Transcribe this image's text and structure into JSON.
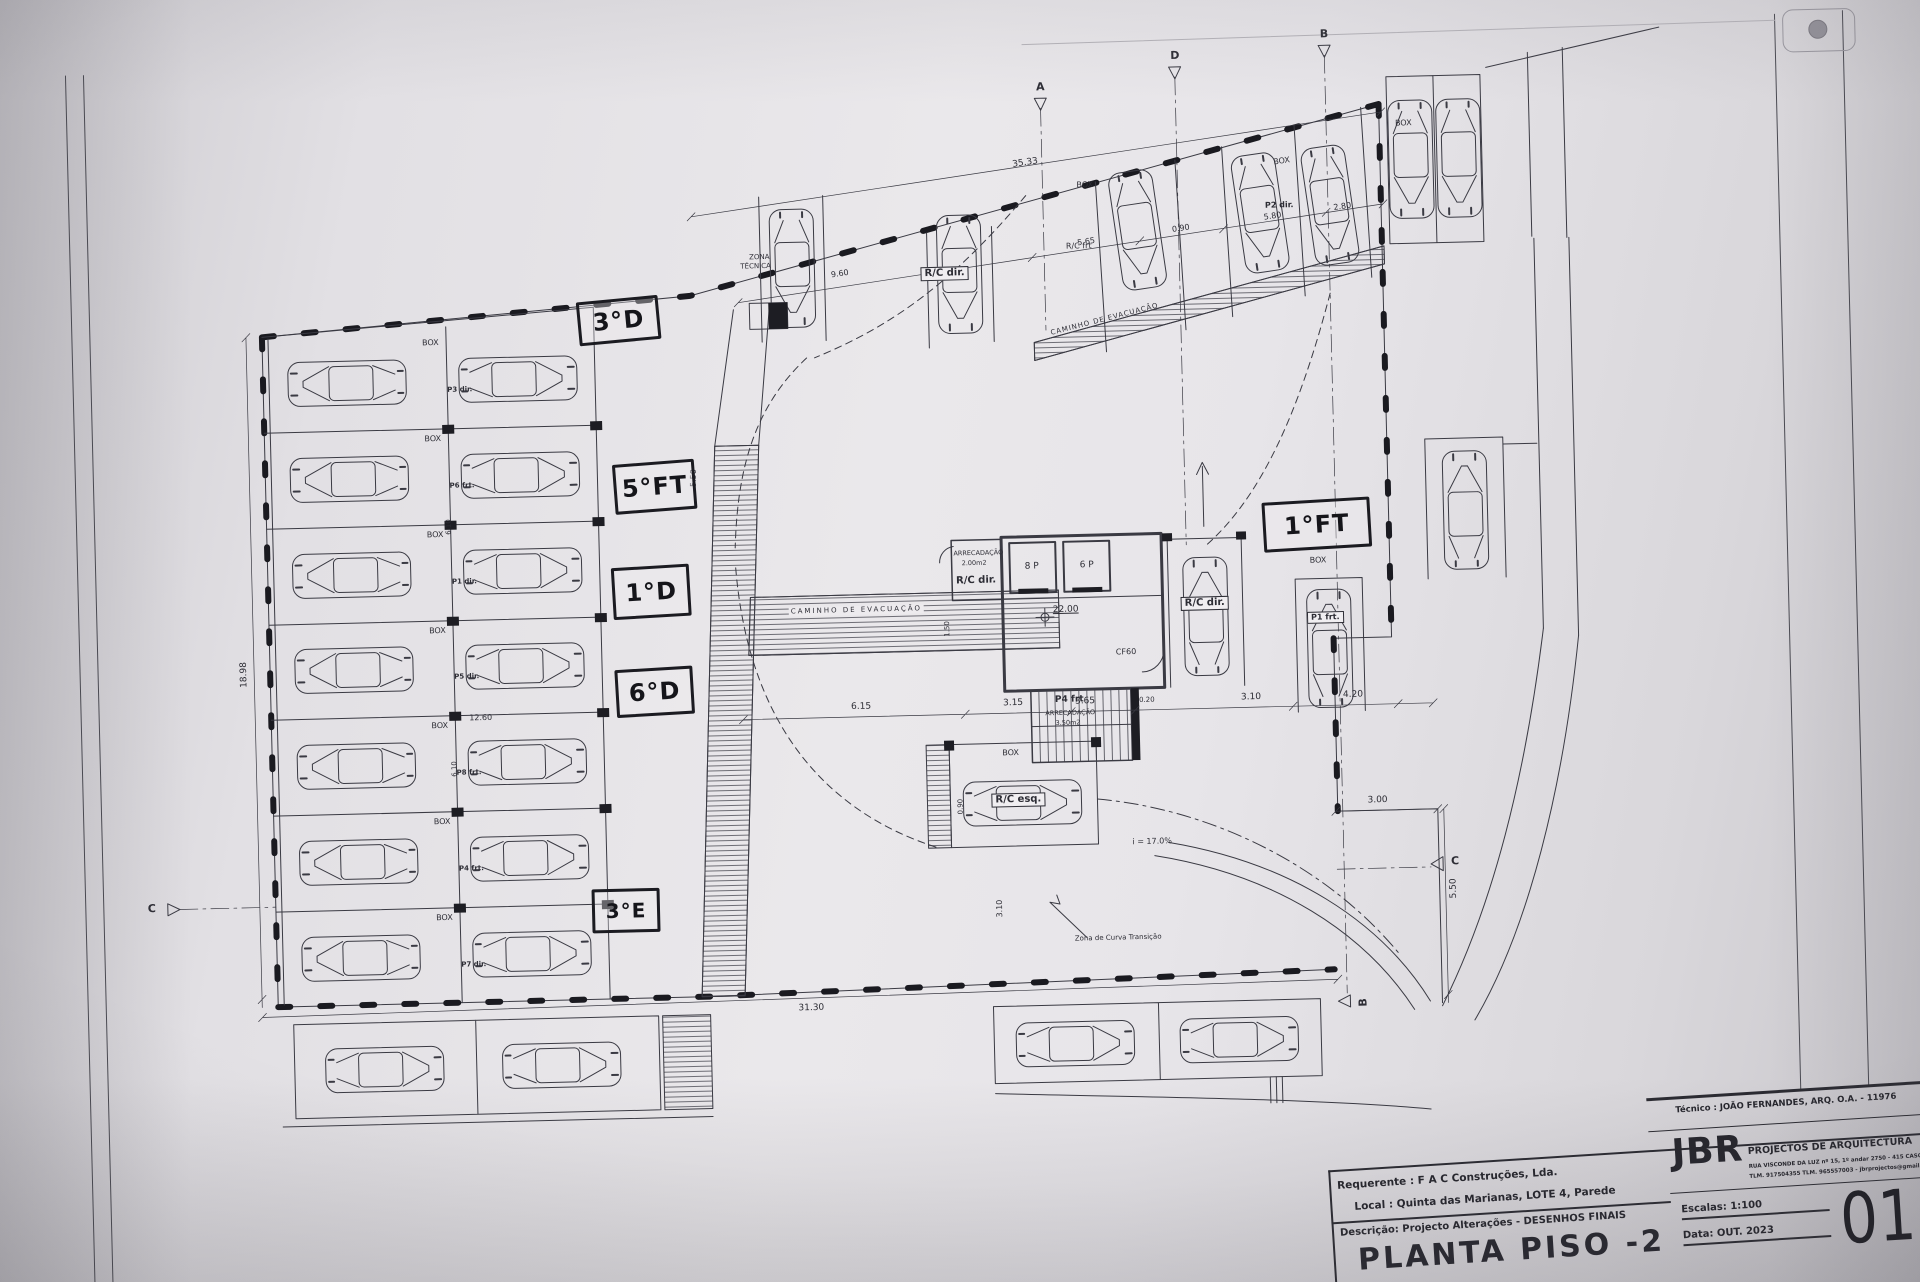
{
  "title_block": {
    "tecnico": "Técnico : JOÃO FERNANDES, ARQ.   O.A. - 11976",
    "firm_initials": "JBR",
    "firm_name": "PROJECTOS DE ARQUITECTURA",
    "firm_address": "RUA VISCONDE DA LUZ nº 15, 1º andar  2750 - 415  CASCAIS",
    "firm_contacts": "TLM. 917504355  TLM. 965557003 - jbrprojectos@gmail.com",
    "requerente_label": "Requerente :",
    "requerente_value": "F A C  Construções, Lda.",
    "local_label": "Local :",
    "local_value": "Quinta das Marianas, LOTE 4, Parede",
    "descricao_label": "Descrição:",
    "descricao_value": "Projecto Alterações - DESENHOS FINAIS",
    "escala": "Escalas:  1:100",
    "data": "Data: OUT.  2023",
    "sheet_number": "01",
    "drawing_title": "PLANTA PISO -2"
  },
  "handwritten": {
    "n3d": "3°D",
    "n5ft": "5°FT",
    "n1d": "1°D",
    "n6d": "6°D",
    "n3e": "3°E",
    "n1ft": "1°FT"
  },
  "labels": {
    "box": "BOX",
    "zona": "ZONA",
    "tecnica": "TÉCNICA",
    "caminho_evacuacao": "CAMINHO  DE  EVACUAÇÃO",
    "arrecadacao": "ARRECADAÇÃO",
    "arrecadacao_area_1": "2.00m2",
    "arrecadacao_area_2": "3.50m2",
    "rc_dir": "R/C dir.",
    "rc_frt": "R/C frt",
    "rc_esq": "R/C esq.",
    "p2_dir": "P2 dir.",
    "p1_frt": "P1 frt.",
    "p4_frt": "P4 frt",
    "lift_8p": "8 P",
    "lift_6p": "6 P",
    "cf60": "CF60",
    "level": "22.00",
    "slope": "i = 17.0%",
    "curva_transicao": "Zona de Curva Transição"
  },
  "left_rows": [
    {
      "box": "BOX",
      "p": "P3 dir."
    },
    {
      "box": "BOX",
      "p": "P6 frt."
    },
    {
      "box": "BOX",
      "p": "P1 dir."
    },
    {
      "box": "BOX",
      "p": "P5 dir."
    },
    {
      "box": "BOX",
      "p": "P8 frt."
    },
    {
      "box": "BOX",
      "p": "P4 frt."
    },
    {
      "box": "BOX",
      "p": "P7 dir."
    }
  ],
  "dims": {
    "d3533": "35.33",
    "d960": "9.60",
    "d565": "5.65",
    "d090": "0.90",
    "d580": "5.80",
    "d280": "2.80",
    "d3130": "31.30",
    "d1260": "12.60",
    "d610": "6.10",
    "d1898": "18.98",
    "d550": "5.50",
    "d150": "1.50",
    "d615": "6.15",
    "d315": "3.15",
    "d365": "3.65",
    "d020": "0.20",
    "d310": "3.10",
    "d420": "4.20",
    "d300": "3.00"
  },
  "markers": {
    "a": "A",
    "b": "B",
    "c": "C",
    "d": "D"
  }
}
